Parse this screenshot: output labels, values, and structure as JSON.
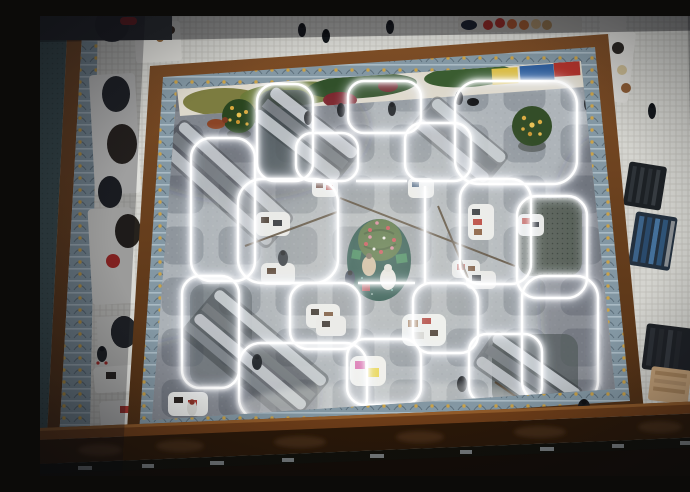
{
  "scene": {
    "type": "photograph",
    "description": "Overhead photograph looking down from an upper balcony into a department store atrium. A white neon light installation of overlapping rounded squares covers the lower sales floor, with a decorated Christmas tree on a dark teal circular platform at its center, white display tables with leather goods inside the light cells, escalators crossing the floor, and ornate wood-and-ironwork railings framing the atrium. Shoppers walk on the floor below and on the surrounding balcony.",
    "setting": "department store atrium, top-down view, holiday season",
    "lighting": "bright white neon glow at center, warm dim vignette at edges",
    "counts": {
      "neon_shapes": 16,
      "display_tables": 14,
      "people": 16,
      "christmas_trees": 3,
      "escalator_banks": 5,
      "clothing_racks": 4
    },
    "palette": {
      "atrium_floor": "#a9afb4",
      "floor_inlay": "#8e959c",
      "neon": "#ffffff",
      "balcony_mosaic": "#e4e3df",
      "railing_wood": "#6b3f1e",
      "railing_ironwork": "#8397a3",
      "ironwork_gold": "#c9a24a",
      "bottom_beam": "#2b1808",
      "tree_platform": "#16443c",
      "tree_green": "#42622e",
      "ornament_red": "#c03840",
      "mural_olive": "#6b7a38",
      "mural_dark_green": "#31502a",
      "mural_dark_red": "#7a242c",
      "mural_yellow": "#d9bb40",
      "mural_blue": "#2f5f9e",
      "lightwell_teal": "#3d5154"
    },
    "elements": {
      "balcony_floor": {
        "description": "white mosaic tile walkways of the upper floor surrounding the atrium",
        "color": "#e4e3df"
      },
      "left_lightwell": {
        "description": "second light well at far left with teal glass and ornate railing",
        "color": "#3d5154"
      },
      "left_walkway_displays": {
        "description": "pedestals with dark handbags, shoes and a red hat on the left walkway",
        "color": "#dfdfdb"
      },
      "top_shelf_displays": {
        "description": "hat displays (red, orange, tan) and a dark canopy along the top walkway",
        "color": "#b23026"
      },
      "atrium_railing": {
        "description": "wooden railing frame with silver Art-Nouveau ironwork and gold floral accents",
        "color": "#6b3f1e"
      },
      "mural_floor_painting": {
        "description": "abstract camouflage floor mural (olive, dark green, dark red, yellow, blue) at the top edge of the lower floor",
        "color": "#6b7a38"
      },
      "atrium_floor": {
        "description": "gray marble sales floor with a grid of darker rounded-square inlays",
        "color": "#a9afb4"
      },
      "neon_installation": {
        "description": "glowing white neon tubes forming overlapping rounded squares of several sizes",
        "color": "#ffffff"
      },
      "center_holiday_display": {
        "description": "Christmas tree with red and pink ornaments on a dark teal circular platform, with a white bear figure, a mannequin and green gift boxes",
        "color": "#16443c"
      },
      "christmas_tree_left": {
        "description": "small gold-decorated Christmas tree near the top-left escalator, with a reddish dog figure",
        "color": "#2a451f"
      },
      "christmas_tree_right": {
        "description": "small gold-decorated Christmas tree beside the top-right escalator",
        "color": "#2a451f"
      },
      "escalators": {
        "description": "metallic escalator banks with glass balustrades crossing the lower floor",
        "color": "#c6cbd0"
      },
      "display_tables": {
        "description": "white rounded display tables holding handbags and small leather goods",
        "color": "#e9eae8"
      },
      "shoppers": {
        "description": "small figures of shoppers seen from directly above",
        "color": "#1d2126"
      },
      "clothing_racks_right": {
        "description": "racks of dark coats and blue denim on the right balcony",
        "color": "#3c6288"
      },
      "bottom_railing_beam": {
        "description": "out-of-focus carved dark wooden railing beam closest to the camera",
        "color": "#2b1808"
      },
      "vignette": {
        "description": "dark warm vignette around the frame edges",
        "color": "#0a0c10"
      }
    }
  }
}
